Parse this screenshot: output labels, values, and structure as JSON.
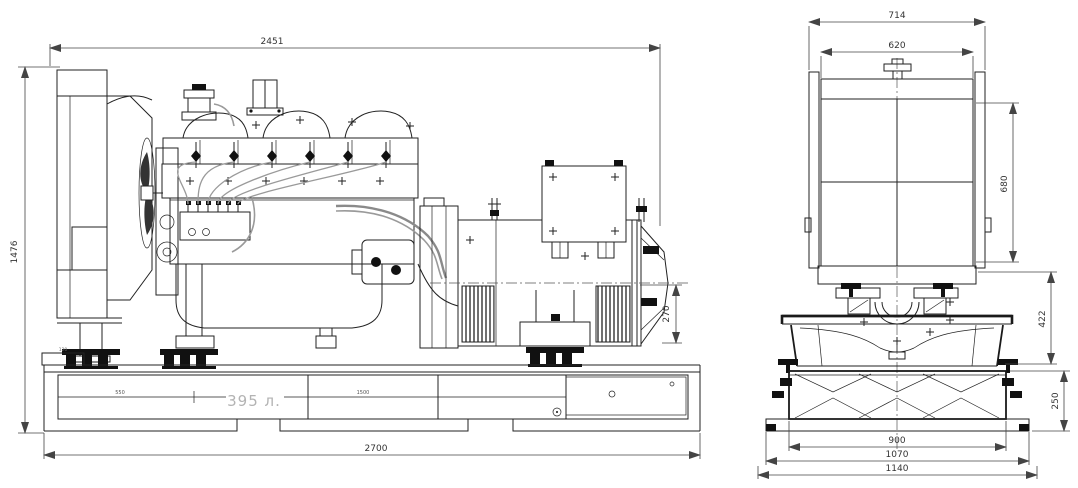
{
  "drawing": {
    "background": "#ffffff",
    "ink": "#222222",
    "side_view": {
      "label": "side-elevation",
      "dims": {
        "overall_length": "2451",
        "overall_height": "1476",
        "alternator_rear_height": "270",
        "base_length": "2700",
        "tank_section_left": "550",
        "tank_section_right": "1500",
        "fuel_tank_capacity": "395 л.",
        "base_step": "120"
      }
    },
    "front_view": {
      "label": "front-elevation",
      "dims": {
        "overall_width": "714",
        "radiator_core_width": "620",
        "radiator_core_height": "680",
        "mounting_height": "422",
        "tank_height": "250",
        "tank_width": "900",
        "skid_width": "1070",
        "overall_base_width": "1140"
      }
    }
  }
}
